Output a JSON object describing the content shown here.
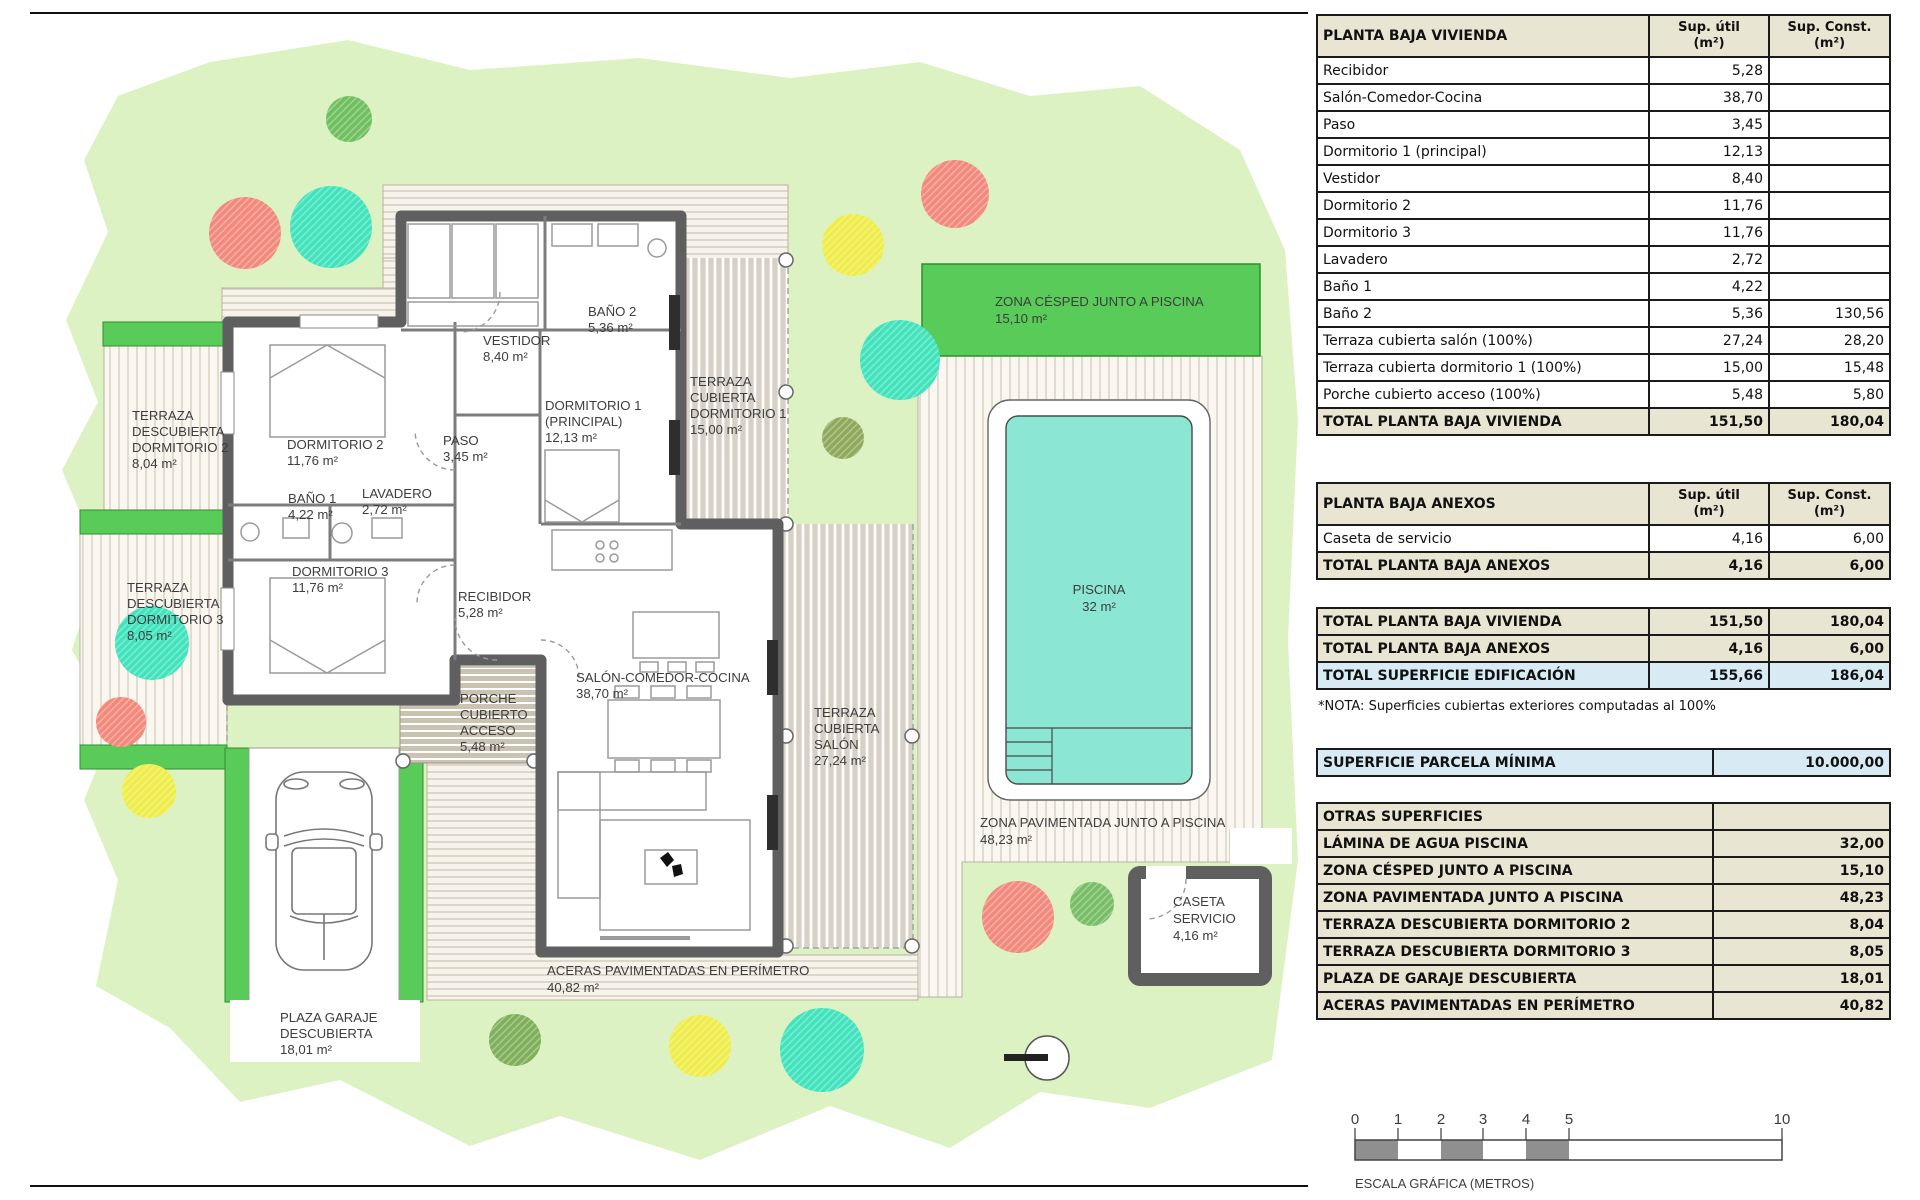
{
  "plan": {
    "labels": {
      "tdd2": [
        "TERRAZA",
        "DESCUBIERTA",
        "DORMITORIO 2",
        "8,04 m²"
      ],
      "tdd3": [
        "TERRAZA",
        "DESCUBIERTA",
        "DORMITORIO 3",
        "8,05 m²"
      ],
      "tcd1": [
        "TERRAZA",
        "CUBIERTA",
        "DORMITORIO 1",
        "15,00 m²"
      ],
      "tcsalon": [
        "TERRAZA",
        "CUBIERTA",
        "SALÓN",
        "27,24 m²"
      ],
      "porche": [
        "PORCHE",
        "CUBIERTO",
        "ACCESO",
        "5,48 m²"
      ],
      "dorm2": [
        "DORMITORIO 2",
        "11,76 m²"
      ],
      "dorm3": [
        "DORMITORIO 3",
        "11,76 m²"
      ],
      "dorm1": [
        "DORMITORIO 1",
        "(PRINCIPAL)",
        "12,13 m²"
      ],
      "bano1": [
        "BAÑO 1",
        "4,22 m²"
      ],
      "bano2": [
        "BAÑO 2",
        "5,36 m²"
      ],
      "lavadero": [
        "LAVADERO",
        "2,72 m²"
      ],
      "vestidor": [
        "VESTIDOR",
        "8,40 m²"
      ],
      "paso": [
        "PASO",
        "3,45 m²"
      ],
      "recibidor": [
        "RECIBIDOR",
        "5,28 m²"
      ],
      "salon": [
        "SALÓN-COMEDOR-COCINA",
        "38,70 m²"
      ],
      "cesped": [
        "ZONA CÉSPED JUNTO A PISCINA",
        "15,10 m²"
      ],
      "piscina": [
        "PISCINA",
        "32 m²"
      ],
      "pavimentada": [
        "ZONA PAVIMENTADA JUNTO A PISCINA",
        "48,23 m²"
      ],
      "caseta": [
        "CASETA",
        "SERVICIO",
        "4,16 m²"
      ],
      "aceras": [
        "ACERAS PAVIMENTADAS EN PERÍMETRO",
        "40,82 m²"
      ],
      "garaje": [
        "PLAZA GARAJE",
        "DESCUBIERTA",
        "18,01 m²"
      ]
    },
    "colors": {
      "lawn": "#DDF2C2",
      "grass_band": "#58CB58",
      "pool": "#8BE7D3",
      "wall": "#5F5F5F",
      "tree_red": "#F2897C",
      "tree_teal": "#41E3BC",
      "tree_yellow": "#EFED49",
      "tree_green": "#6FBF5F",
      "tree_olive": "#8FA95C",
      "table_beige": "#E9E5D3",
      "table_blue": "#D8EBF4"
    }
  },
  "tables": {
    "cols": {
      "util": "Sup. útil\n(m²)",
      "const": "Sup. Const.\n(m²)"
    },
    "vivienda": {
      "title": "PLANTA BAJA VIVIENDA",
      "rows": [
        {
          "kind": "data",
          "cells": [
            "Recibidor",
            "5,28",
            ""
          ]
        },
        {
          "kind": "data",
          "cells": [
            "Salón-Comedor-Cocina",
            "38,70",
            ""
          ]
        },
        {
          "kind": "data",
          "cells": [
            "Paso",
            "3,45",
            ""
          ]
        },
        {
          "kind": "data",
          "cells": [
            "Dormitorio 1 (principal)",
            "12,13",
            ""
          ]
        },
        {
          "kind": "data",
          "cells": [
            "Vestidor",
            "8,40",
            ""
          ]
        },
        {
          "kind": "data",
          "cells": [
            "Dormitorio 2",
            "11,76",
            ""
          ]
        },
        {
          "kind": "data",
          "cells": [
            "Dormitorio 3",
            "11,76",
            ""
          ]
        },
        {
          "kind": "data",
          "cells": [
            "Lavadero",
            "2,72",
            ""
          ]
        },
        {
          "kind": "data",
          "cells": [
            "Baño 1",
            "4,22",
            ""
          ]
        },
        {
          "kind": "data",
          "cells": [
            "Baño 2",
            "5,36",
            "130,56"
          ]
        },
        {
          "kind": "data",
          "cells": [
            "Terraza cubierta salón (100%)",
            "27,24",
            "28,20"
          ]
        },
        {
          "kind": "data",
          "cells": [
            "Terraza cubierta dormitorio 1 (100%)",
            "15,00",
            "15,48"
          ]
        },
        {
          "kind": "data",
          "cells": [
            "Porche cubierto acceso (100%)",
            "5,48",
            "5,80"
          ]
        },
        {
          "kind": "total",
          "cells": [
            "TOTAL PLANTA BAJA VIVIENDA",
            "151,50",
            "180,04"
          ]
        }
      ]
    },
    "anexos": {
      "title": "PLANTA BAJA ANEXOS",
      "rows": [
        {
          "kind": "data",
          "cells": [
            "Caseta de servicio",
            "4,16",
            "6,00"
          ]
        },
        {
          "kind": "total",
          "cells": [
            "TOTAL PLANTA BAJA ANEXOS",
            "4,16",
            "6,00"
          ]
        }
      ]
    },
    "resumen": {
      "rows": [
        {
          "kind": "total",
          "cells": [
            "TOTAL PLANTA BAJA VIVIENDA",
            "151,50",
            "180,04"
          ]
        },
        {
          "kind": "total",
          "cells": [
            "TOTAL PLANTA BAJA ANEXOS",
            "4,16",
            "6,00"
          ]
        },
        {
          "kind": "blue",
          "cells": [
            "TOTAL SUPERFICIE EDIFICACIÓN",
            "155,66",
            "186,04"
          ]
        }
      ],
      "note": "*NOTA: Superficies cubiertas exteriores computadas al 100%"
    },
    "parcela": {
      "rows": [
        {
          "kind": "blue",
          "cells": [
            "SUPERFICIE PARCELA MÍNIMA",
            "10.000,00"
          ]
        }
      ]
    },
    "otras": {
      "title": "OTRAS SUPERFICIES",
      "rows": [
        {
          "kind": "total",
          "cells": [
            "LÁMINA DE AGUA PISCINA",
            "32,00"
          ]
        },
        {
          "kind": "total",
          "cells": [
            "ZONA CÉSPED JUNTO A PISCINA",
            "15,10"
          ]
        },
        {
          "kind": "total",
          "cells": [
            "ZONA PAVIMENTADA JUNTO A PISCINA",
            "48,23"
          ]
        },
        {
          "kind": "total",
          "cells": [
            "TERRAZA DESCUBIERTA DORMITORIO 2",
            "8,04"
          ]
        },
        {
          "kind": "total",
          "cells": [
            "TERRAZA DESCUBIERTA DORMITORIO 3",
            "8,05"
          ]
        },
        {
          "kind": "total",
          "cells": [
            "PLAZA DE GARAJE DESCUBIERTA",
            "18,01"
          ]
        },
        {
          "kind": "total",
          "cells": [
            "ACERAS PAVIMENTADAS EN PERÍMETRO",
            "40,82"
          ]
        }
      ]
    }
  },
  "scalebar": {
    "ticks": [
      "0",
      "1",
      "2",
      "3",
      "4",
      "5",
      "10"
    ],
    "caption": "ESCALA GRÁFICA (METROS)"
  }
}
